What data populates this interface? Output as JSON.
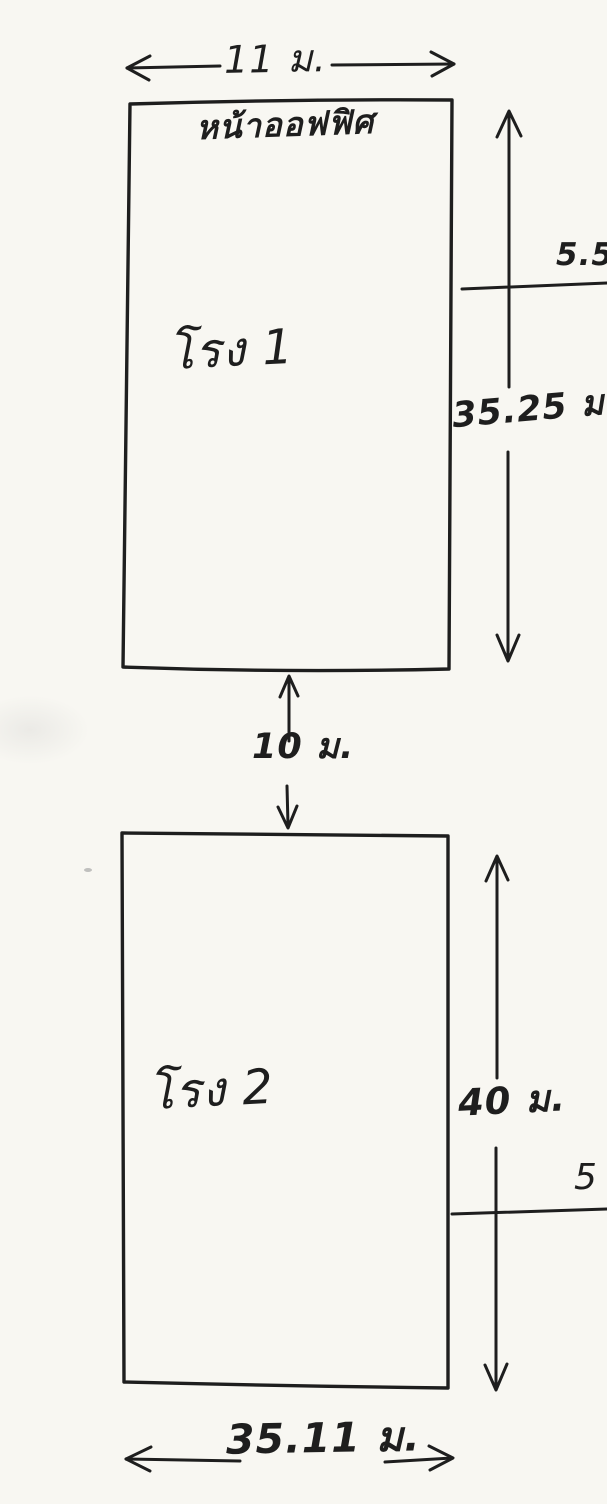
{
  "colors": {
    "paper": "#f8f7f2",
    "ink": "#1e1e1e"
  },
  "top_dimension": {
    "label": "11 ม."
  },
  "building1": {
    "front_label": "หน้าออฟฟิศ",
    "name_label": "โรง 1",
    "height_dimension": {
      "label": "35.25 ม."
    },
    "side_offset": {
      "label": "5.5"
    }
  },
  "gap_dimension": {
    "label": "10 ม."
  },
  "building2": {
    "name_label": "โรง 2",
    "height_dimension": {
      "label": "40 ม."
    },
    "side_offset": {
      "label": "5"
    }
  },
  "bottom_dimension": {
    "label": "35.11 ม."
  }
}
